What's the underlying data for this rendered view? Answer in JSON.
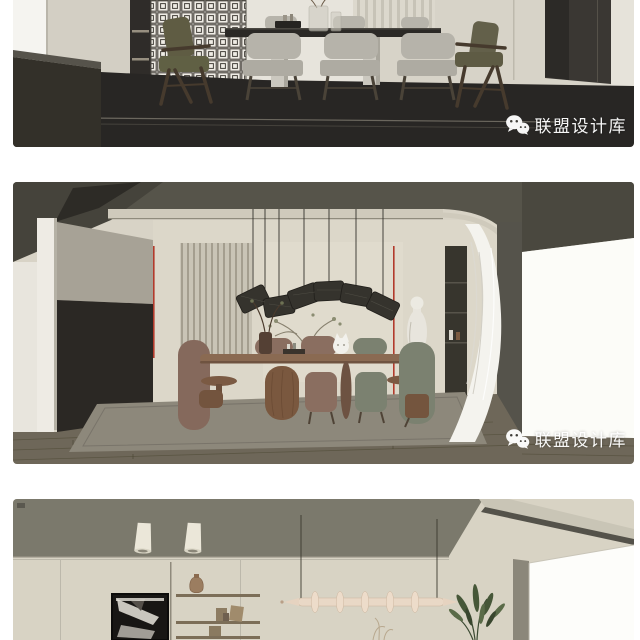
{
  "page": {
    "background": "#ffffff"
  },
  "watermark": {
    "text": "联盟设计库",
    "icon": "wechat-icon",
    "color": "#ffffff"
  },
  "figures": [
    {
      "id": "top",
      "alt": "Dining room render: long dark-top table, grey upholstered chairs, olive wood armchairs, lattice screen, dark floor"
    },
    {
      "id": "middle",
      "alt": "Dining room render: dark coved ceiling, arc of woven pendant lights, oval wood table, mauve and sage chairs, sheer curtain, bright window"
    },
    {
      "id": "bottom",
      "alt": "Living room render: cream walls, black abstract artwork, open shelving with vases, sculptural horizontal pendant light, indoor plant"
    }
  ],
  "colors": {
    "accent_red": "#b23a2c",
    "dark_floor": "#282624",
    "wall_beige": "#d8d3c6",
    "ceiling_gray": "#57554b",
    "wood_floor": "#6e6759",
    "mauve_chair": "#8a6e60",
    "sage_chair": "#7b8170",
    "cream_pendant": "#e9d8c6"
  }
}
